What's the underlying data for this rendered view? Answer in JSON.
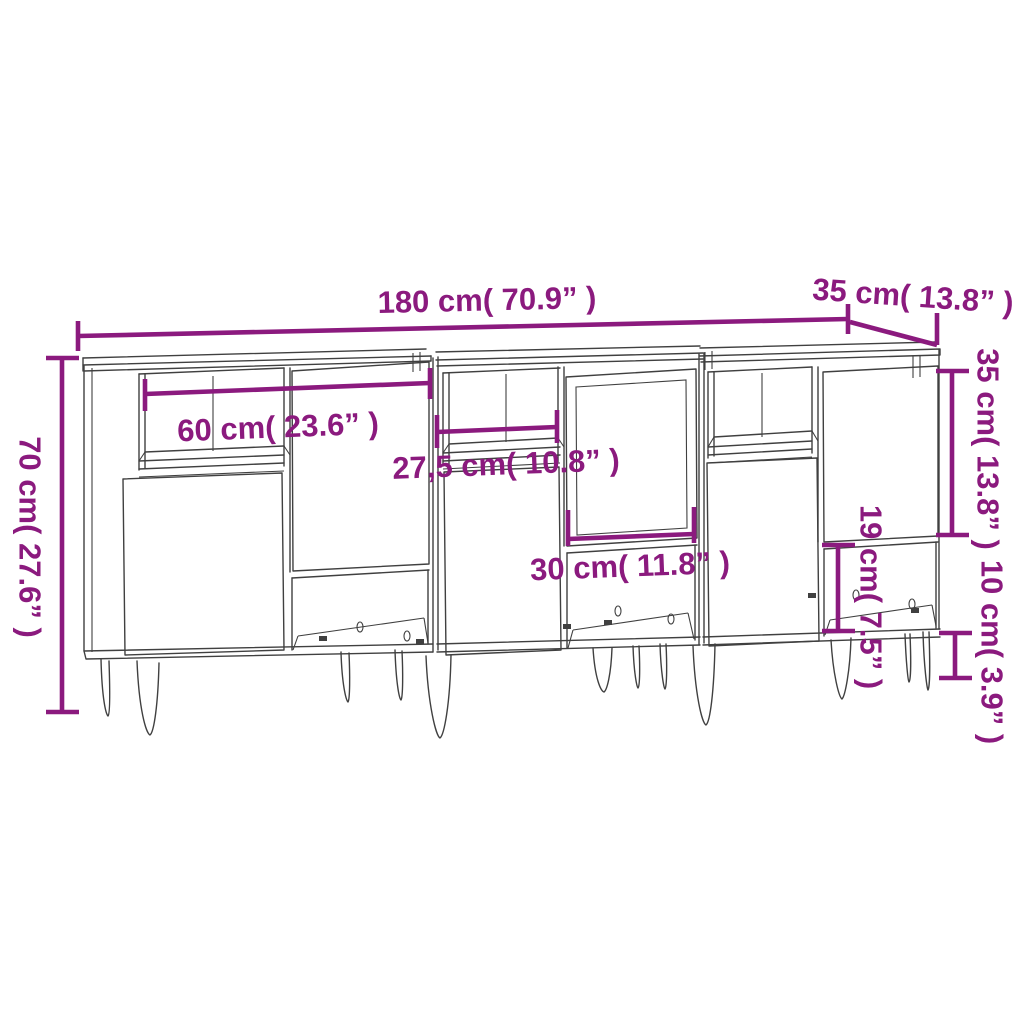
{
  "diagram": {
    "type": "furniture-dimension-diagram",
    "subject": "three-sideboard-set-line-drawing",
    "colors": {
      "accent": "#8B1A7E",
      "line": "#404040",
      "background": "#FFFFFF"
    },
    "labels": {
      "total_width": "180 cm( 70.9” )",
      "depth": "35 cm( 13.8” )",
      "total_height": "70 cm( 27.6” )",
      "left_niche_width": "60 cm( 23.6” )",
      "middle_niche_width": "27,5 cm( 10.8” )",
      "door_width": "30 cm( 11.8” )",
      "upper_right_height": "35 cm( 13.8” )",
      "lower_niche_height": "19 cm( 7.5” )",
      "leg_height": "10 cm( 3.9” )"
    }
  }
}
